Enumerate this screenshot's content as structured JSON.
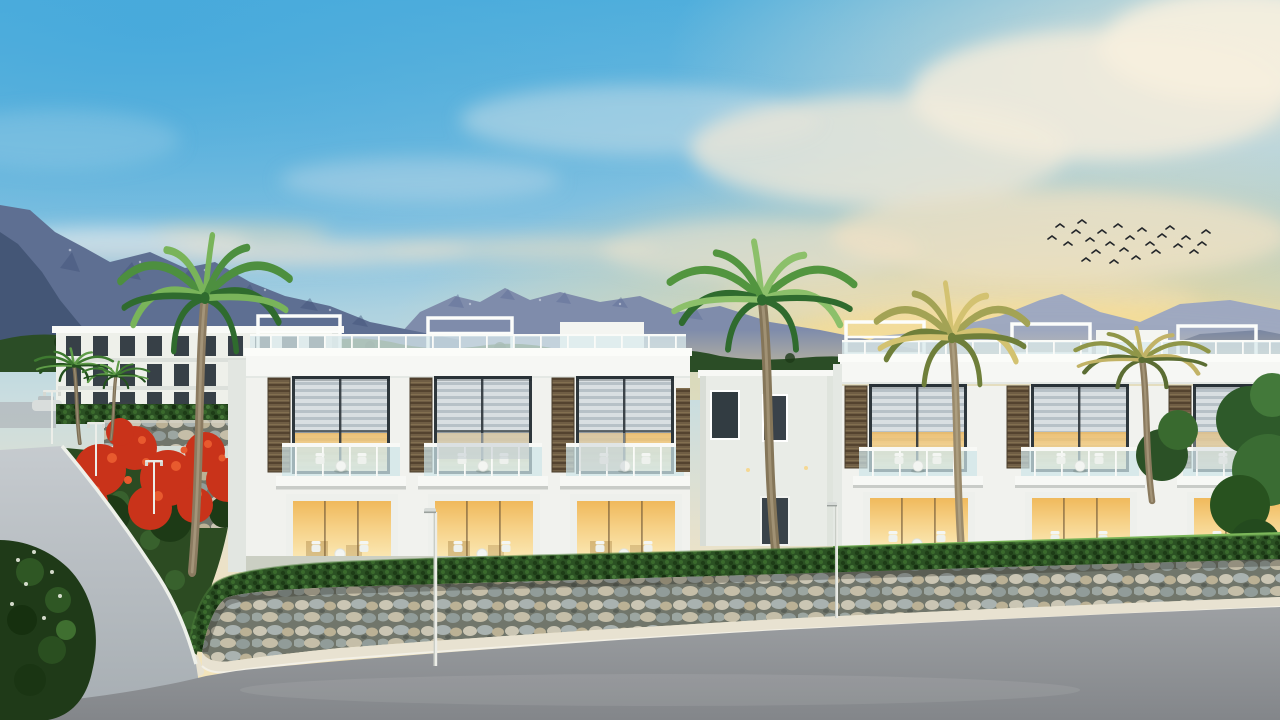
{
  "scene": {
    "type": "3d-architectural-rendering",
    "subject": "Modern white two-storey villa complex at sunset",
    "description": "Sunset architectural rendering of a modern white seaside villa complex: two rows of two-storey townhouses with glass balconies, brown louver panels and warm-lit windows, palm trees, red flowering bushes, a stone retaining wall topped by a hedge, street lamps and a grey asphalt road in the foreground, with hazy blue mountains and a flock of birds in a golden evening sky",
    "time_of_day": "sunset",
    "weather": "clear with soft clouds"
  },
  "palette": {
    "sky_blue": "#53b0dd",
    "sky_cream": "#f3e8cd",
    "sunset_gold": "#f6d98e",
    "mountain_far": "#9aa5c2",
    "mountain_mid": "#7f8cab",
    "mountain_near": "#5e6f92",
    "building_white": "#f1f2ee",
    "louver_brown": "#6f5d44",
    "window_blind_grey": "#c6ced3",
    "lit_window_gold": "#f6d187",
    "balcony_glass": "#cfe4e9",
    "hedge_green": "#2b5123",
    "grass_green": "#74b054",
    "flower_red": "#c9331a",
    "palm_green": "#4d8f3f",
    "palm_trunk": "#8b7b61",
    "stone_grey": "#a9b2b0",
    "stone_tan": "#c5bea8",
    "road_grey": "#8d9093",
    "sidewalk_cream": "#e8e2d1",
    "bird_black": "#23262a"
  },
  "inventory": {
    "townhouse_units_left_block": 3,
    "townhouse_units_right_block": 3,
    "apartment_building_floors": 3,
    "palm_trees_large": 4,
    "palm_trees_small": 2,
    "street_lamps": 5,
    "birds_in_flock": 25,
    "parked_cars": 2
  }
}
